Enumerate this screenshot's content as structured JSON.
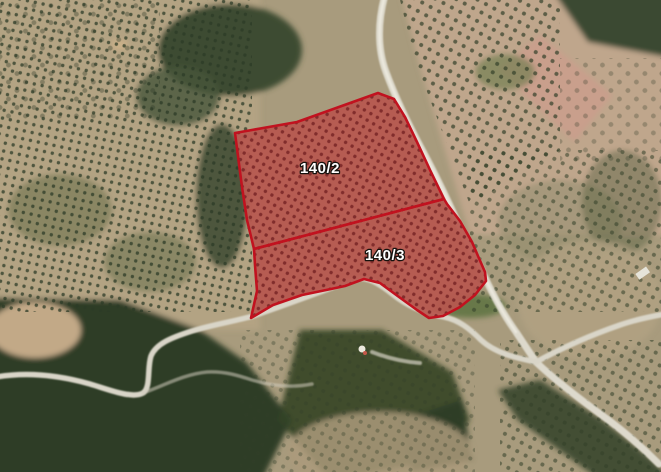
{
  "map": {
    "description": "Aerial satellite view of rural terrain with olive groves, bare fields, dense scrub woodland and winding light-colored country roads",
    "overlay_type": "cadastral parcel boundary overlay"
  },
  "parcels": {
    "border_color": "#c1121f",
    "fill_color": "rgba(193,18,31,0.40)",
    "label_color": "#ffffff",
    "items": [
      {
        "id": "140/2",
        "label": "140/2",
        "points": "235,133 297,122 378,93 394,99 405,117 417,142 430,170 444,199 254,249 247,220 242,187"
      },
      {
        "id": "140/3",
        "label": "140/3",
        "points": "254,249 444,199 447,204 460,221 472,242 478,256 485,272 486,281 475,295 460,307 443,316 429,318 417,310 399,297 380,283 364,279 345,286 331,289 302,295 273,305 251,318 257,291 255,265"
      }
    ]
  },
  "palette": {
    "soil_tan": "#ac9d7f",
    "forest_green": "#31402b",
    "road_light": "#ddd9cc",
    "pink_field": "#c99f8c"
  }
}
